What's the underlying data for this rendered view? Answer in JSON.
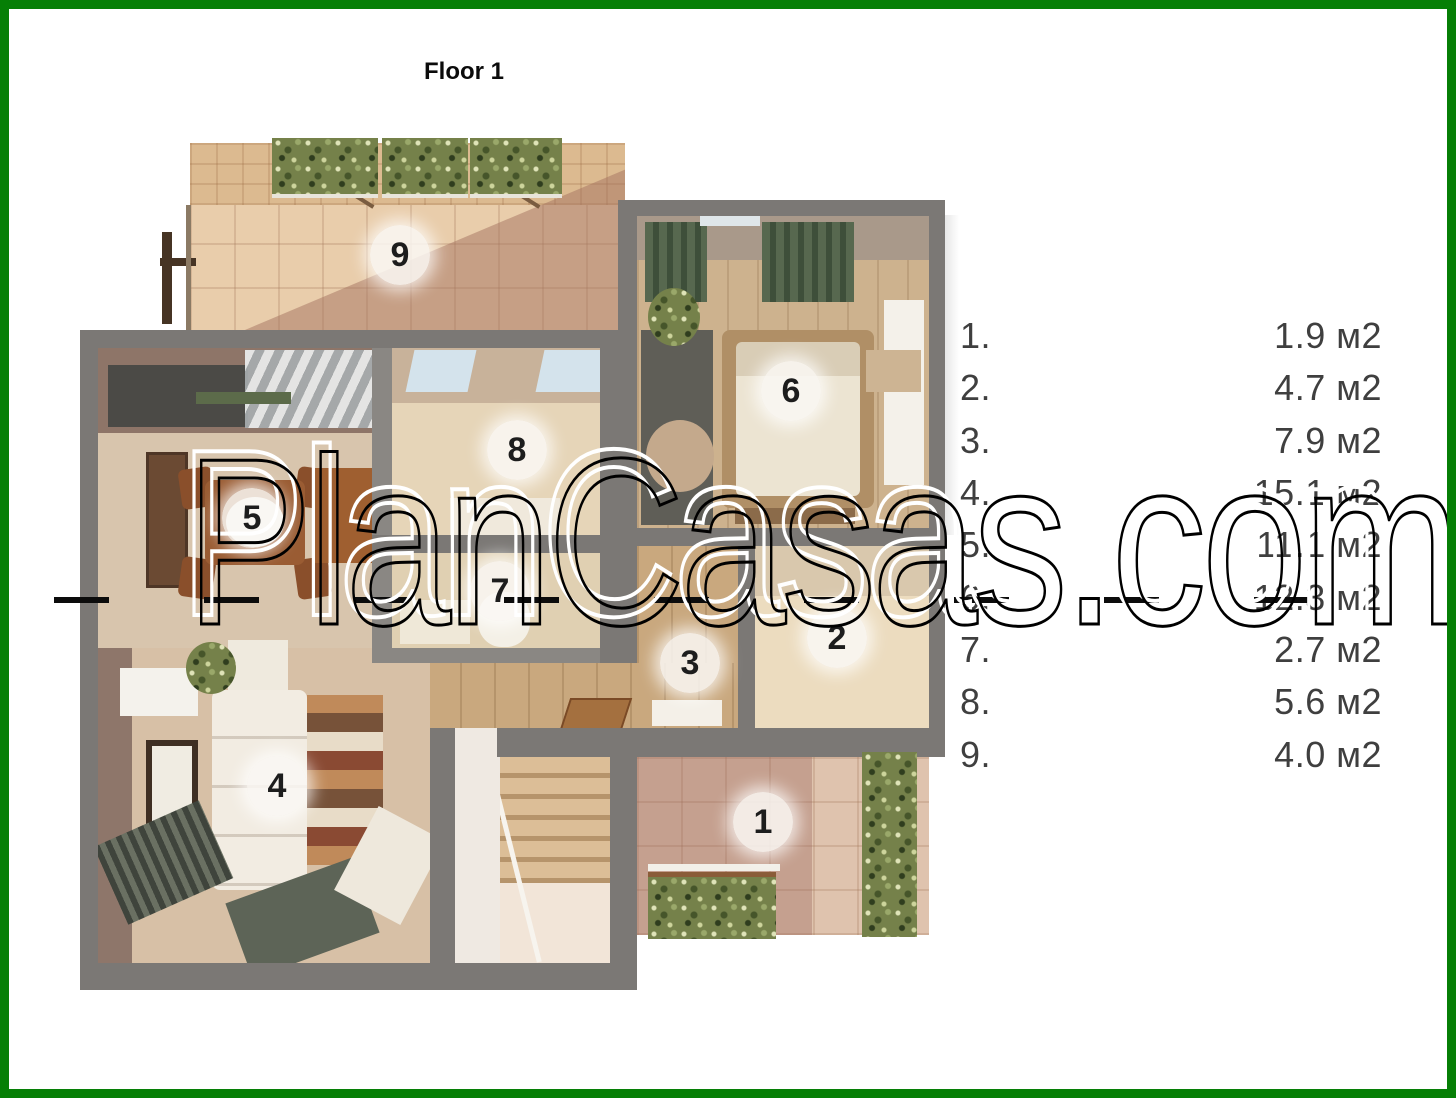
{
  "title": "Floor 1",
  "watermark": {
    "text": "PlanCasas.com"
  },
  "plan": {
    "rooms": [
      {
        "number": "1"
      },
      {
        "number": "2"
      },
      {
        "number": "3"
      },
      {
        "number": "4"
      },
      {
        "number": "5"
      },
      {
        "number": "6"
      },
      {
        "number": "7"
      },
      {
        "number": "8"
      },
      {
        "number": "9"
      }
    ]
  },
  "legend": {
    "items": [
      {
        "num": "1.",
        "area": "1.9 м2"
      },
      {
        "num": "2.",
        "area": "4.7 м2"
      },
      {
        "num": "3.",
        "area": "7.9 м2"
      },
      {
        "num": "4.",
        "area": "15.1 м2"
      },
      {
        "num": "5.",
        "area": "11.1 м2"
      },
      {
        "num": "6.",
        "area": "12.3 м2"
      },
      {
        "num": "7.",
        "area": "2.7 м2"
      },
      {
        "num": "8.",
        "area": "5.6 м2"
      },
      {
        "num": "9.",
        "area": "4.0 м2"
      }
    ]
  },
  "colors": {
    "frame_green": "#067f06",
    "wall_gray": "#7b7875"
  }
}
